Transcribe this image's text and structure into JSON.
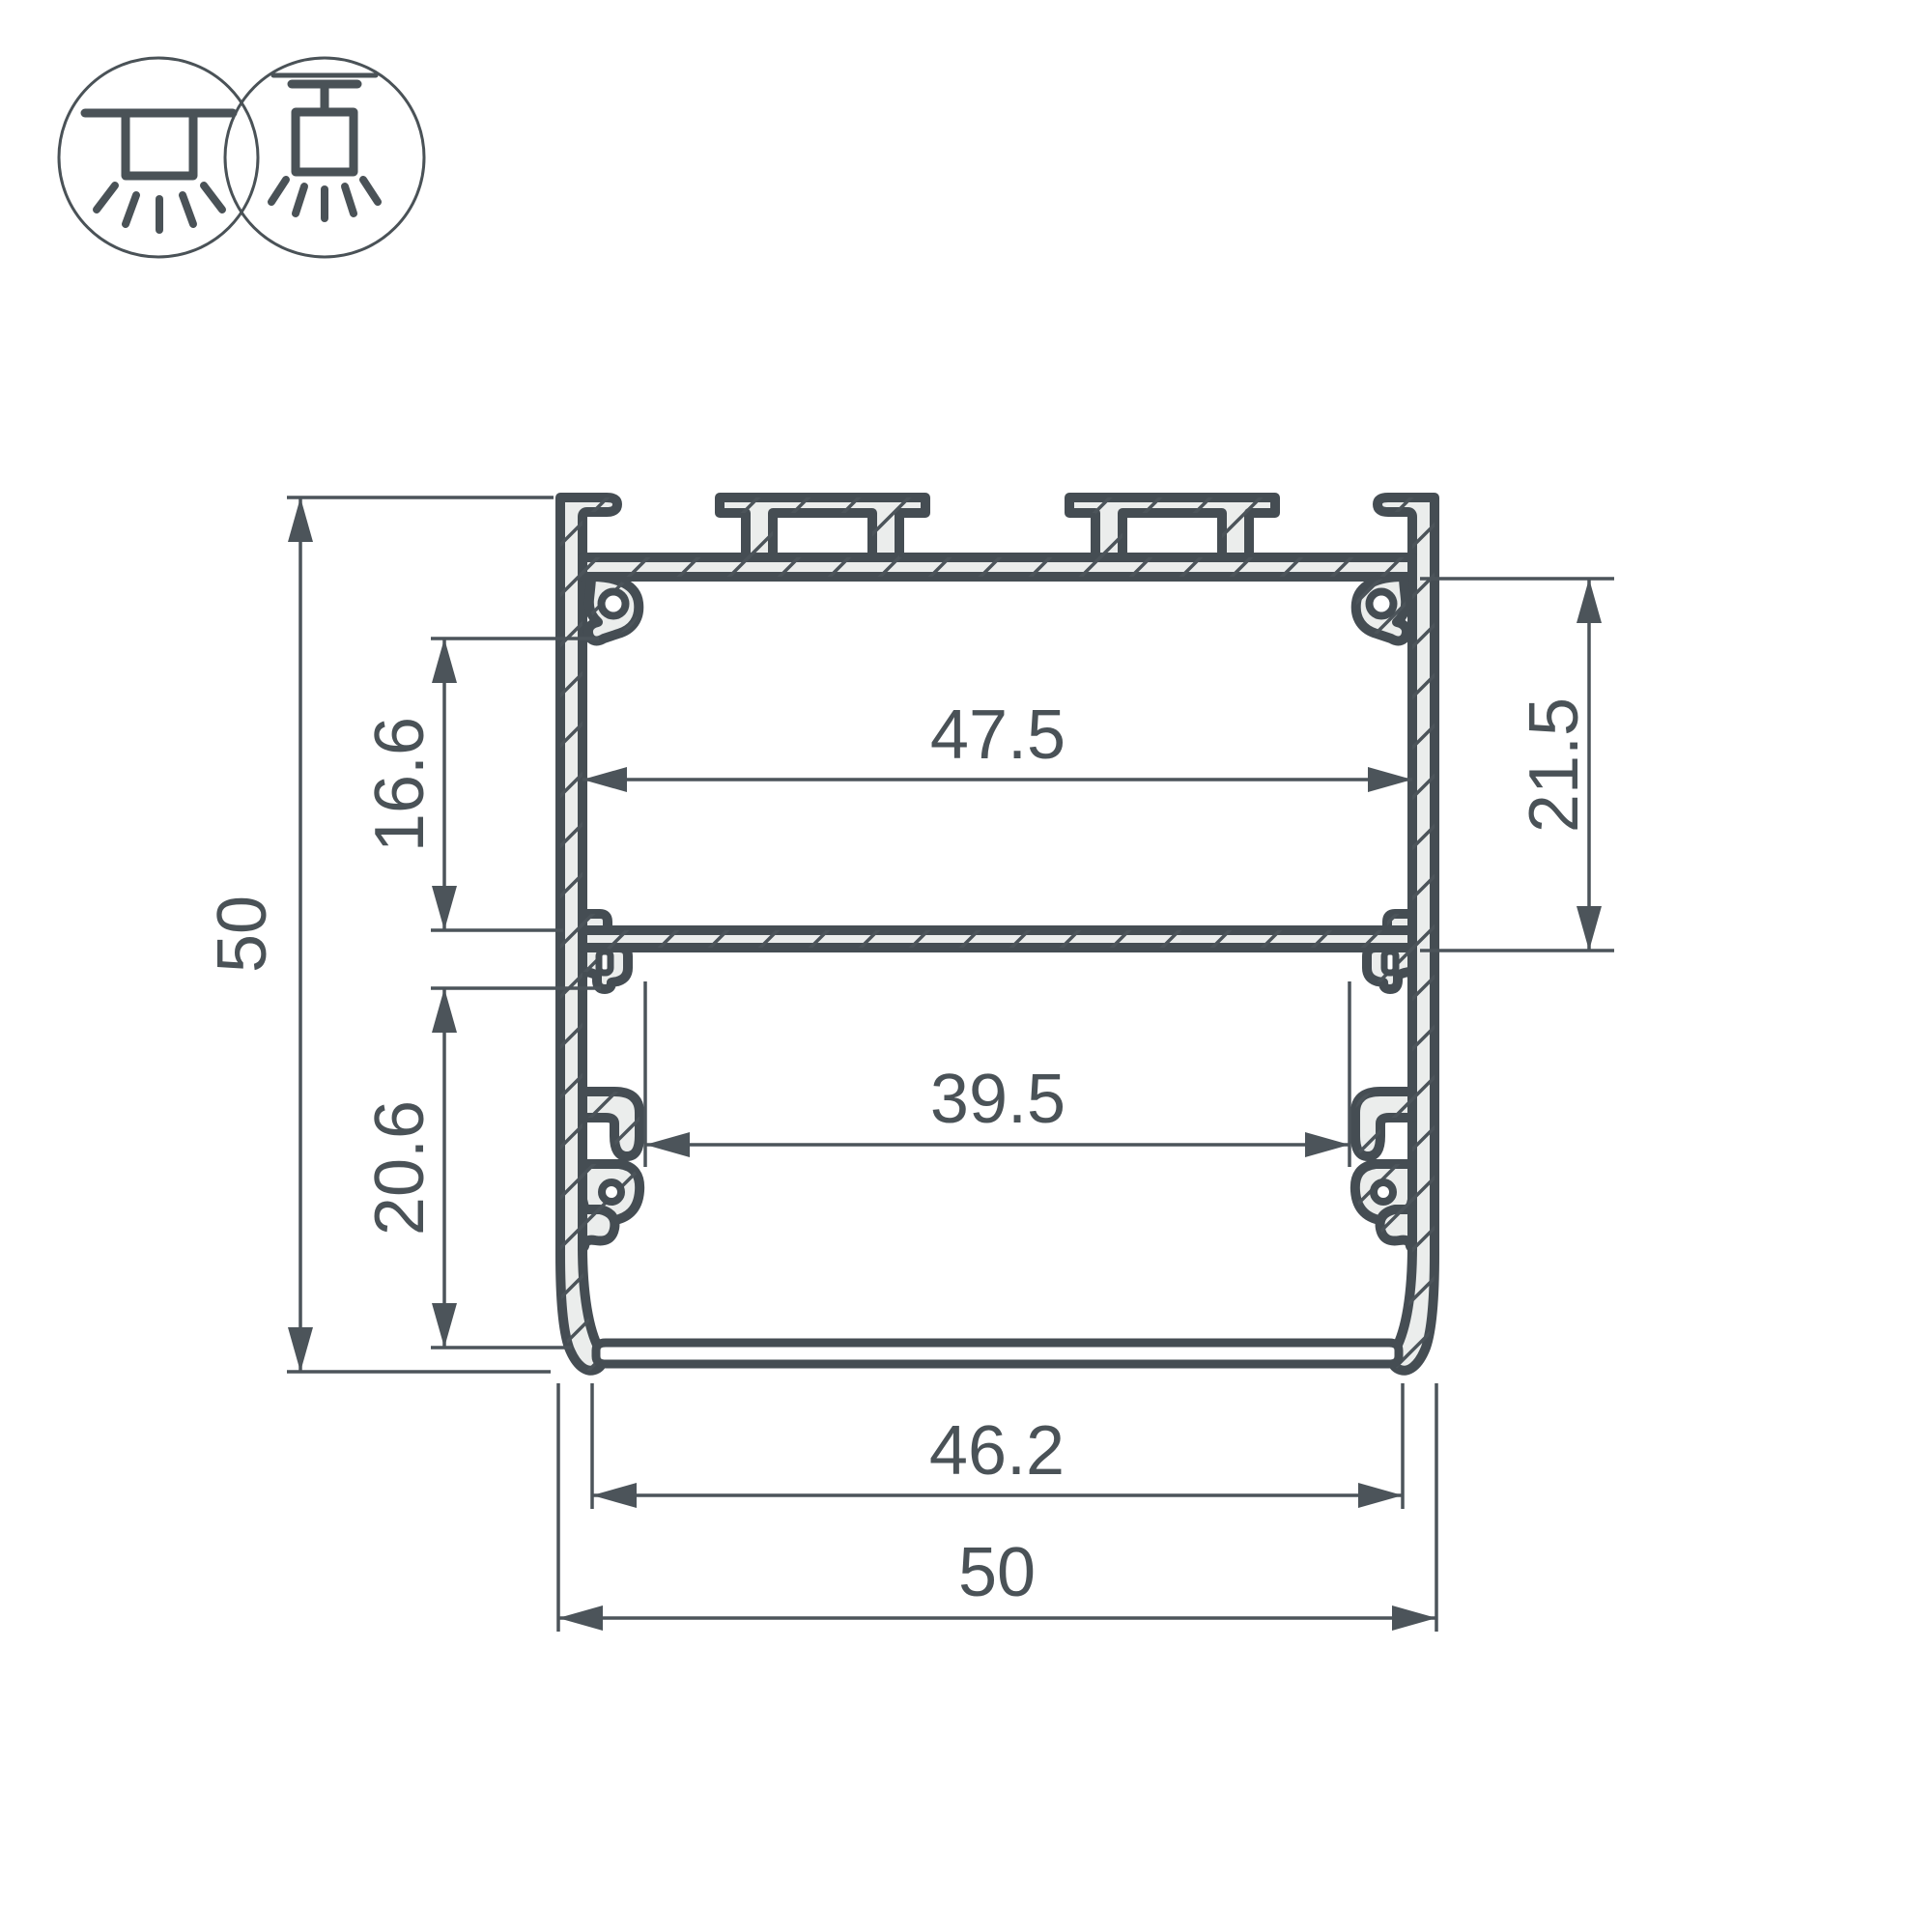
{
  "drawing": {
    "kind": "aluminium-led-profile-cross-section",
    "dimensions": {
      "overall_height": "50",
      "upper_cavity_height": "16.6",
      "lower_cavity_height": "20.6",
      "upper_cavity_width": "47.5",
      "right_cavity_depth": "21.5",
      "lower_cavity_width": "39.5",
      "base_width": "46.2",
      "overall_width": "50"
    },
    "icons": {
      "first": "surface-mount-light-icon",
      "second": "pendant-mount-light-icon"
    },
    "colors": {
      "outline": "#454d53",
      "thin_line": "#4c545a",
      "metal_fill": "#ebedec",
      "background": "#ffffff",
      "text": "#4a5257"
    }
  }
}
